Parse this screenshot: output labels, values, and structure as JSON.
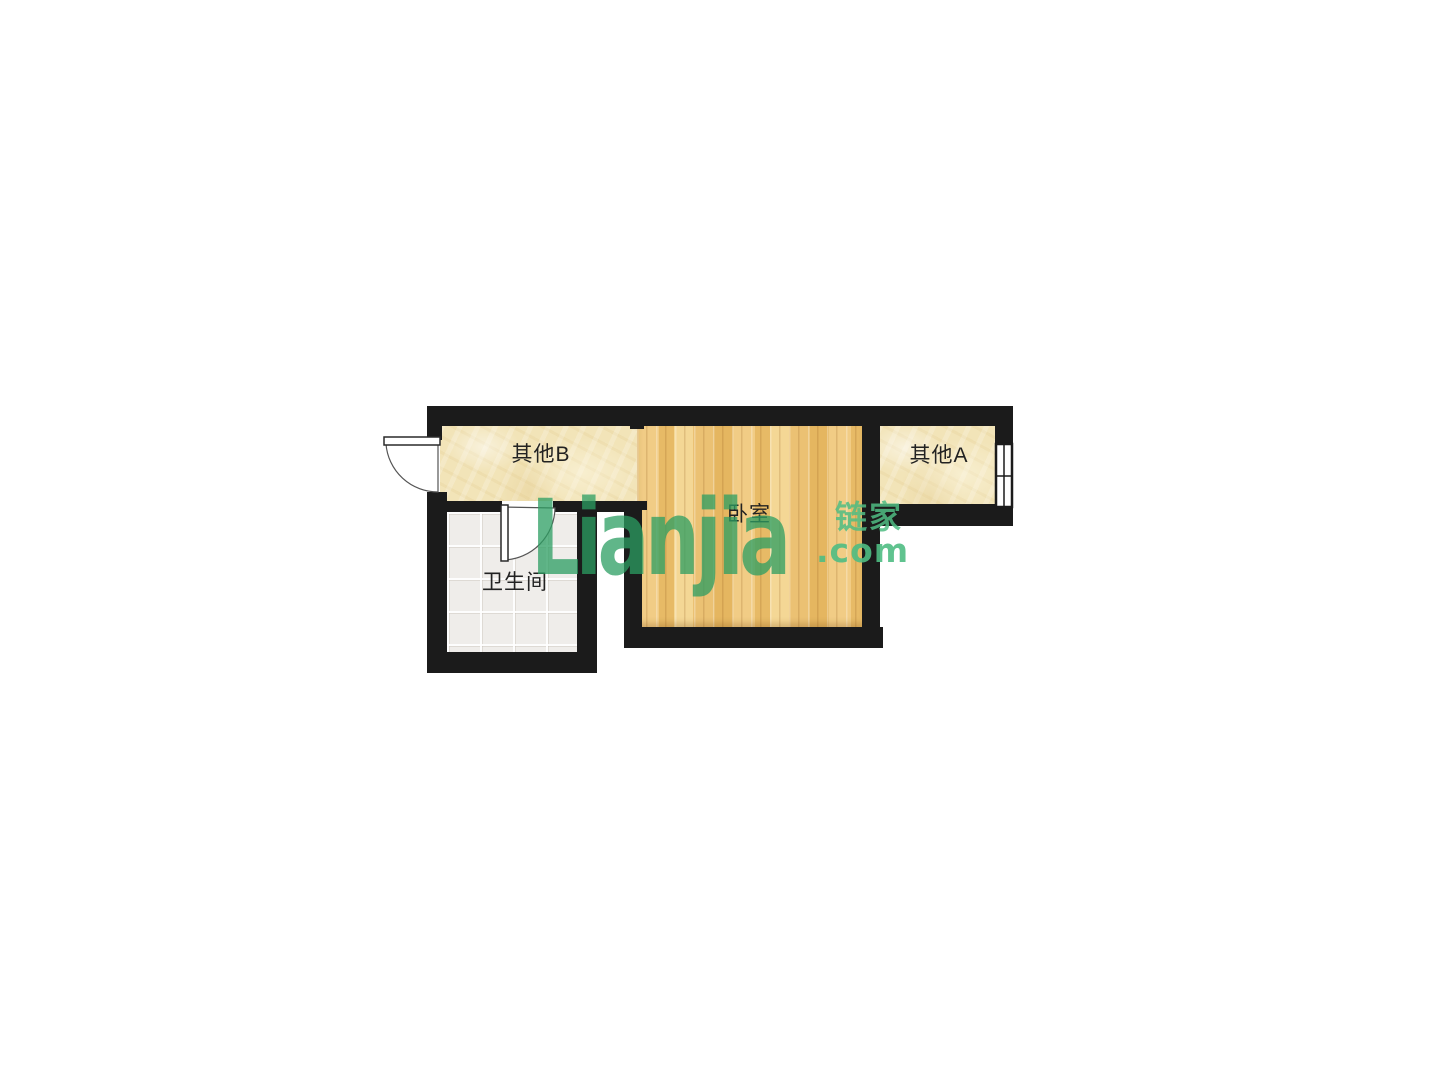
{
  "floorplan": {
    "rooms": [
      {
        "id": "other-b",
        "label": "其他B"
      },
      {
        "id": "bedroom",
        "label": "卧室"
      },
      {
        "id": "other-a",
        "label": "其他A"
      },
      {
        "id": "bathroom",
        "label": "卫生间"
      }
    ],
    "watermark": {
      "wordmark": "Lianjia",
      "cn": "链家",
      "suffix": ".com"
    },
    "colors": {
      "page_bg": "#ffffff",
      "wall": "#1b1b1b",
      "floor_cream": "#f2e4b8",
      "floor_wood": "#eec377",
      "floor_tile": "#efedea",
      "label": "#222222",
      "door_stroke": "#555555",
      "watermark": "#2c9e62",
      "watermark_light": "#4fbd83"
    }
  }
}
